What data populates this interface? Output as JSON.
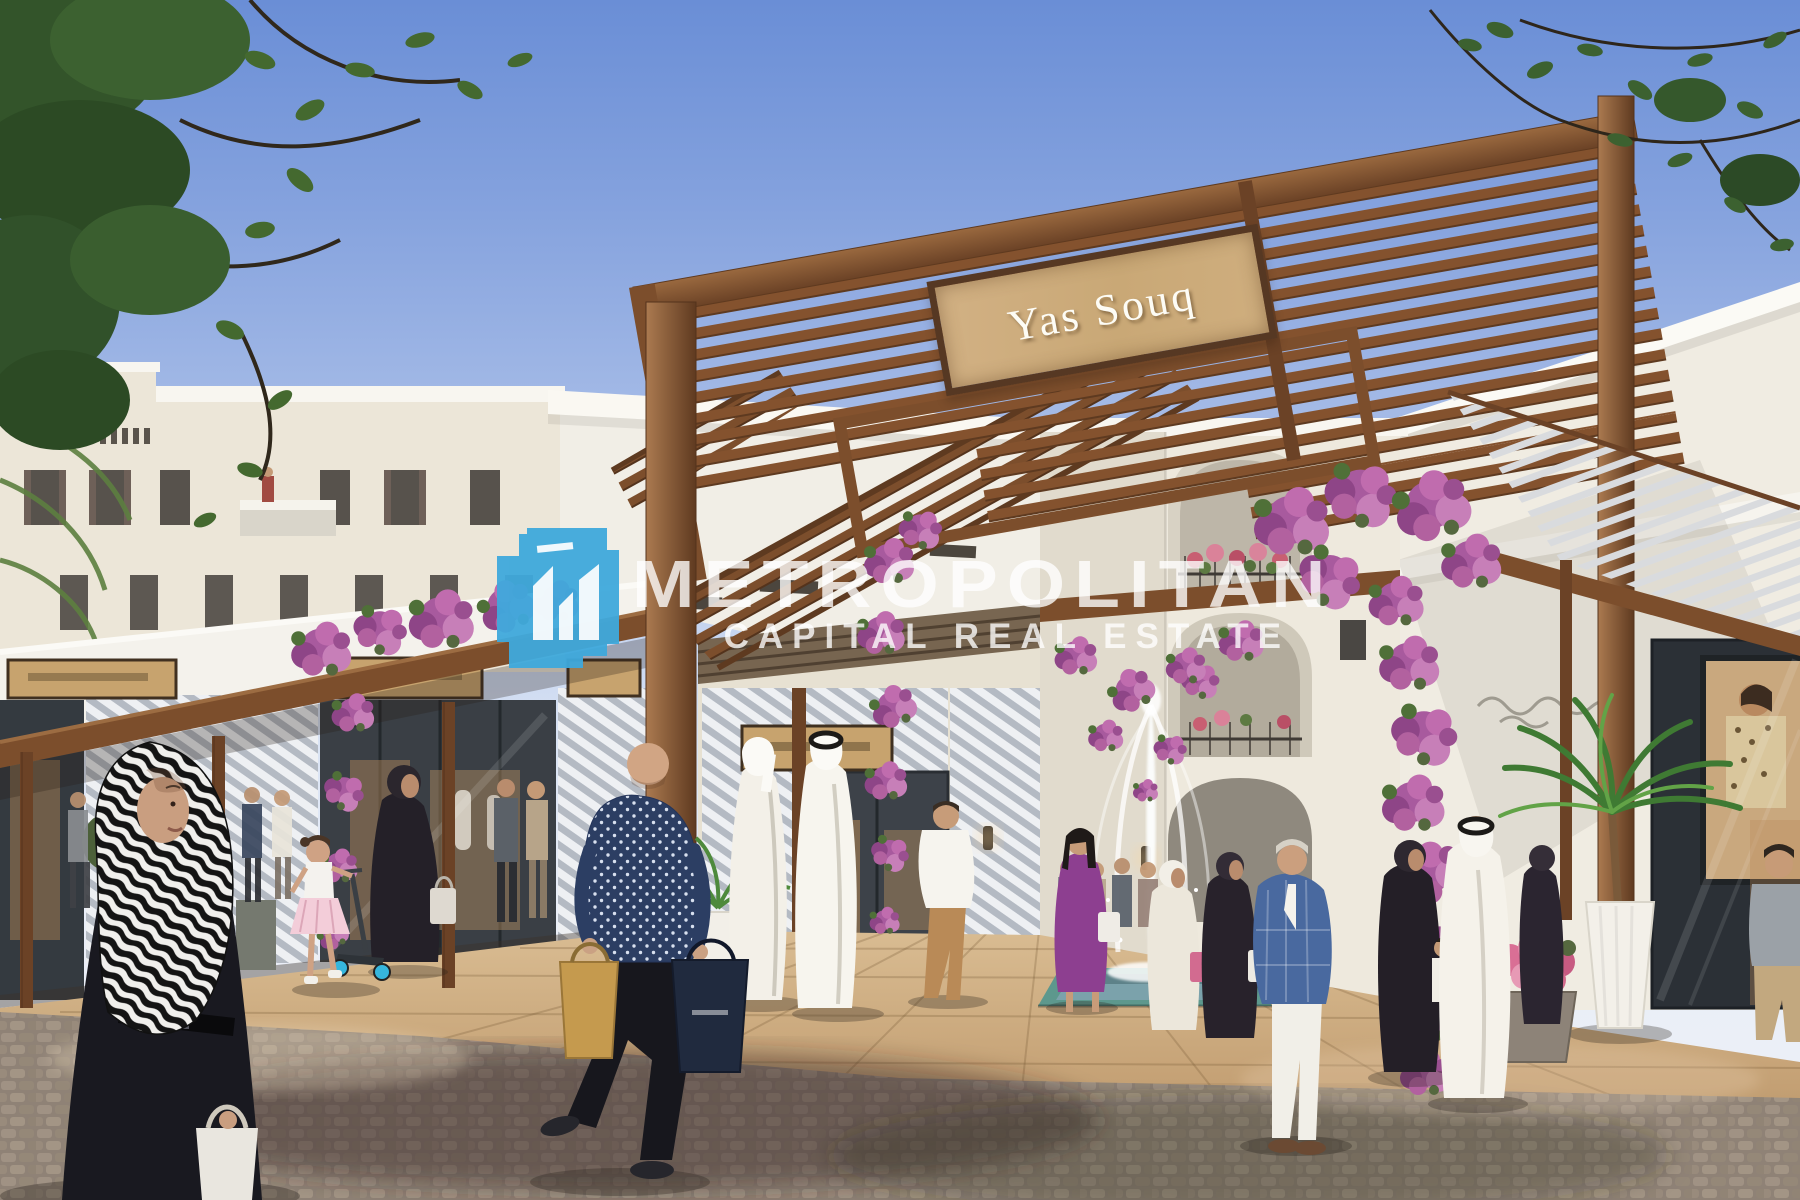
{
  "sign": {
    "text": "Yas Souq"
  },
  "watermark": {
    "brand": "METROPOLITAN",
    "tagline": "CAPITAL REAL ESTATE"
  },
  "colors": {
    "sky_top": "#6a8ed6",
    "sky_mid": "#b7c9ec",
    "sky_horizon": "#e9eef8",
    "wood": "#8a5a36",
    "wood_dark": "#6b4226",
    "wood_light": "#a4714a",
    "sign_board": "#c9a876",
    "sign_text": "#fdfcf5",
    "building_white": "#f3f1ea",
    "building_cream": "#ece5d4",
    "louver_shadow": "#b4bac3",
    "bougainvillea": "#a85a9e",
    "bougainvillea_light": "#c77fb8",
    "leaf_green": "#4a6b35",
    "plaza_tile": "#c7a478",
    "cobblestone": "#8f8276",
    "pool_rim": "#5d988d",
    "water_jet": "#ffffff",
    "logo_blue": "#3fa9dc",
    "watermark_text": "rgba(255,255,255,0.78)"
  },
  "scene": {
    "setting": "Sunny retail souq entrance plaza, architectural rendering",
    "landmark_sign": "Yas Souq",
    "features": [
      "tree-canopy-left",
      "tree-canopy-right",
      "residential-building-left",
      "white-souq-facade",
      "timber-gate-pergola",
      "yas-souq-sign-board",
      "sloped-timber-canopy",
      "left-retail-arcade",
      "louvered-shopfronts",
      "shop-transom-signs",
      "central-tower-arched-balconies",
      "entrance-passage",
      "wall-sconces",
      "fountain-jet",
      "reflecting-pool",
      "bougainvillea-vines",
      "palm-in-white-planter",
      "olive-tree-in-egg-planter",
      "pink-flower-planter",
      "stone-tile-plaza",
      "cobblestone-foreground",
      "right-retail-wing",
      "fashion-shop-window-poster"
    ],
    "people": [
      "woman-zebra-print-hijab-black-abaya",
      "girl-pink-tutu-with-scooter",
      "woman-black-abaya",
      "bald-man-polka-dot-shirt-with-shopping-bags",
      "two-men-white-kandura",
      "man-white-shirt-khaki-pants",
      "woman-purple-dress",
      "women-with-shopping-bags",
      "gray-haired-man-blue-blazer-white-pants",
      "man-kandura-right",
      "women-abaya-right",
      "man-casual-far-right",
      "background-shoppers",
      "people-on-balconies"
    ]
  }
}
